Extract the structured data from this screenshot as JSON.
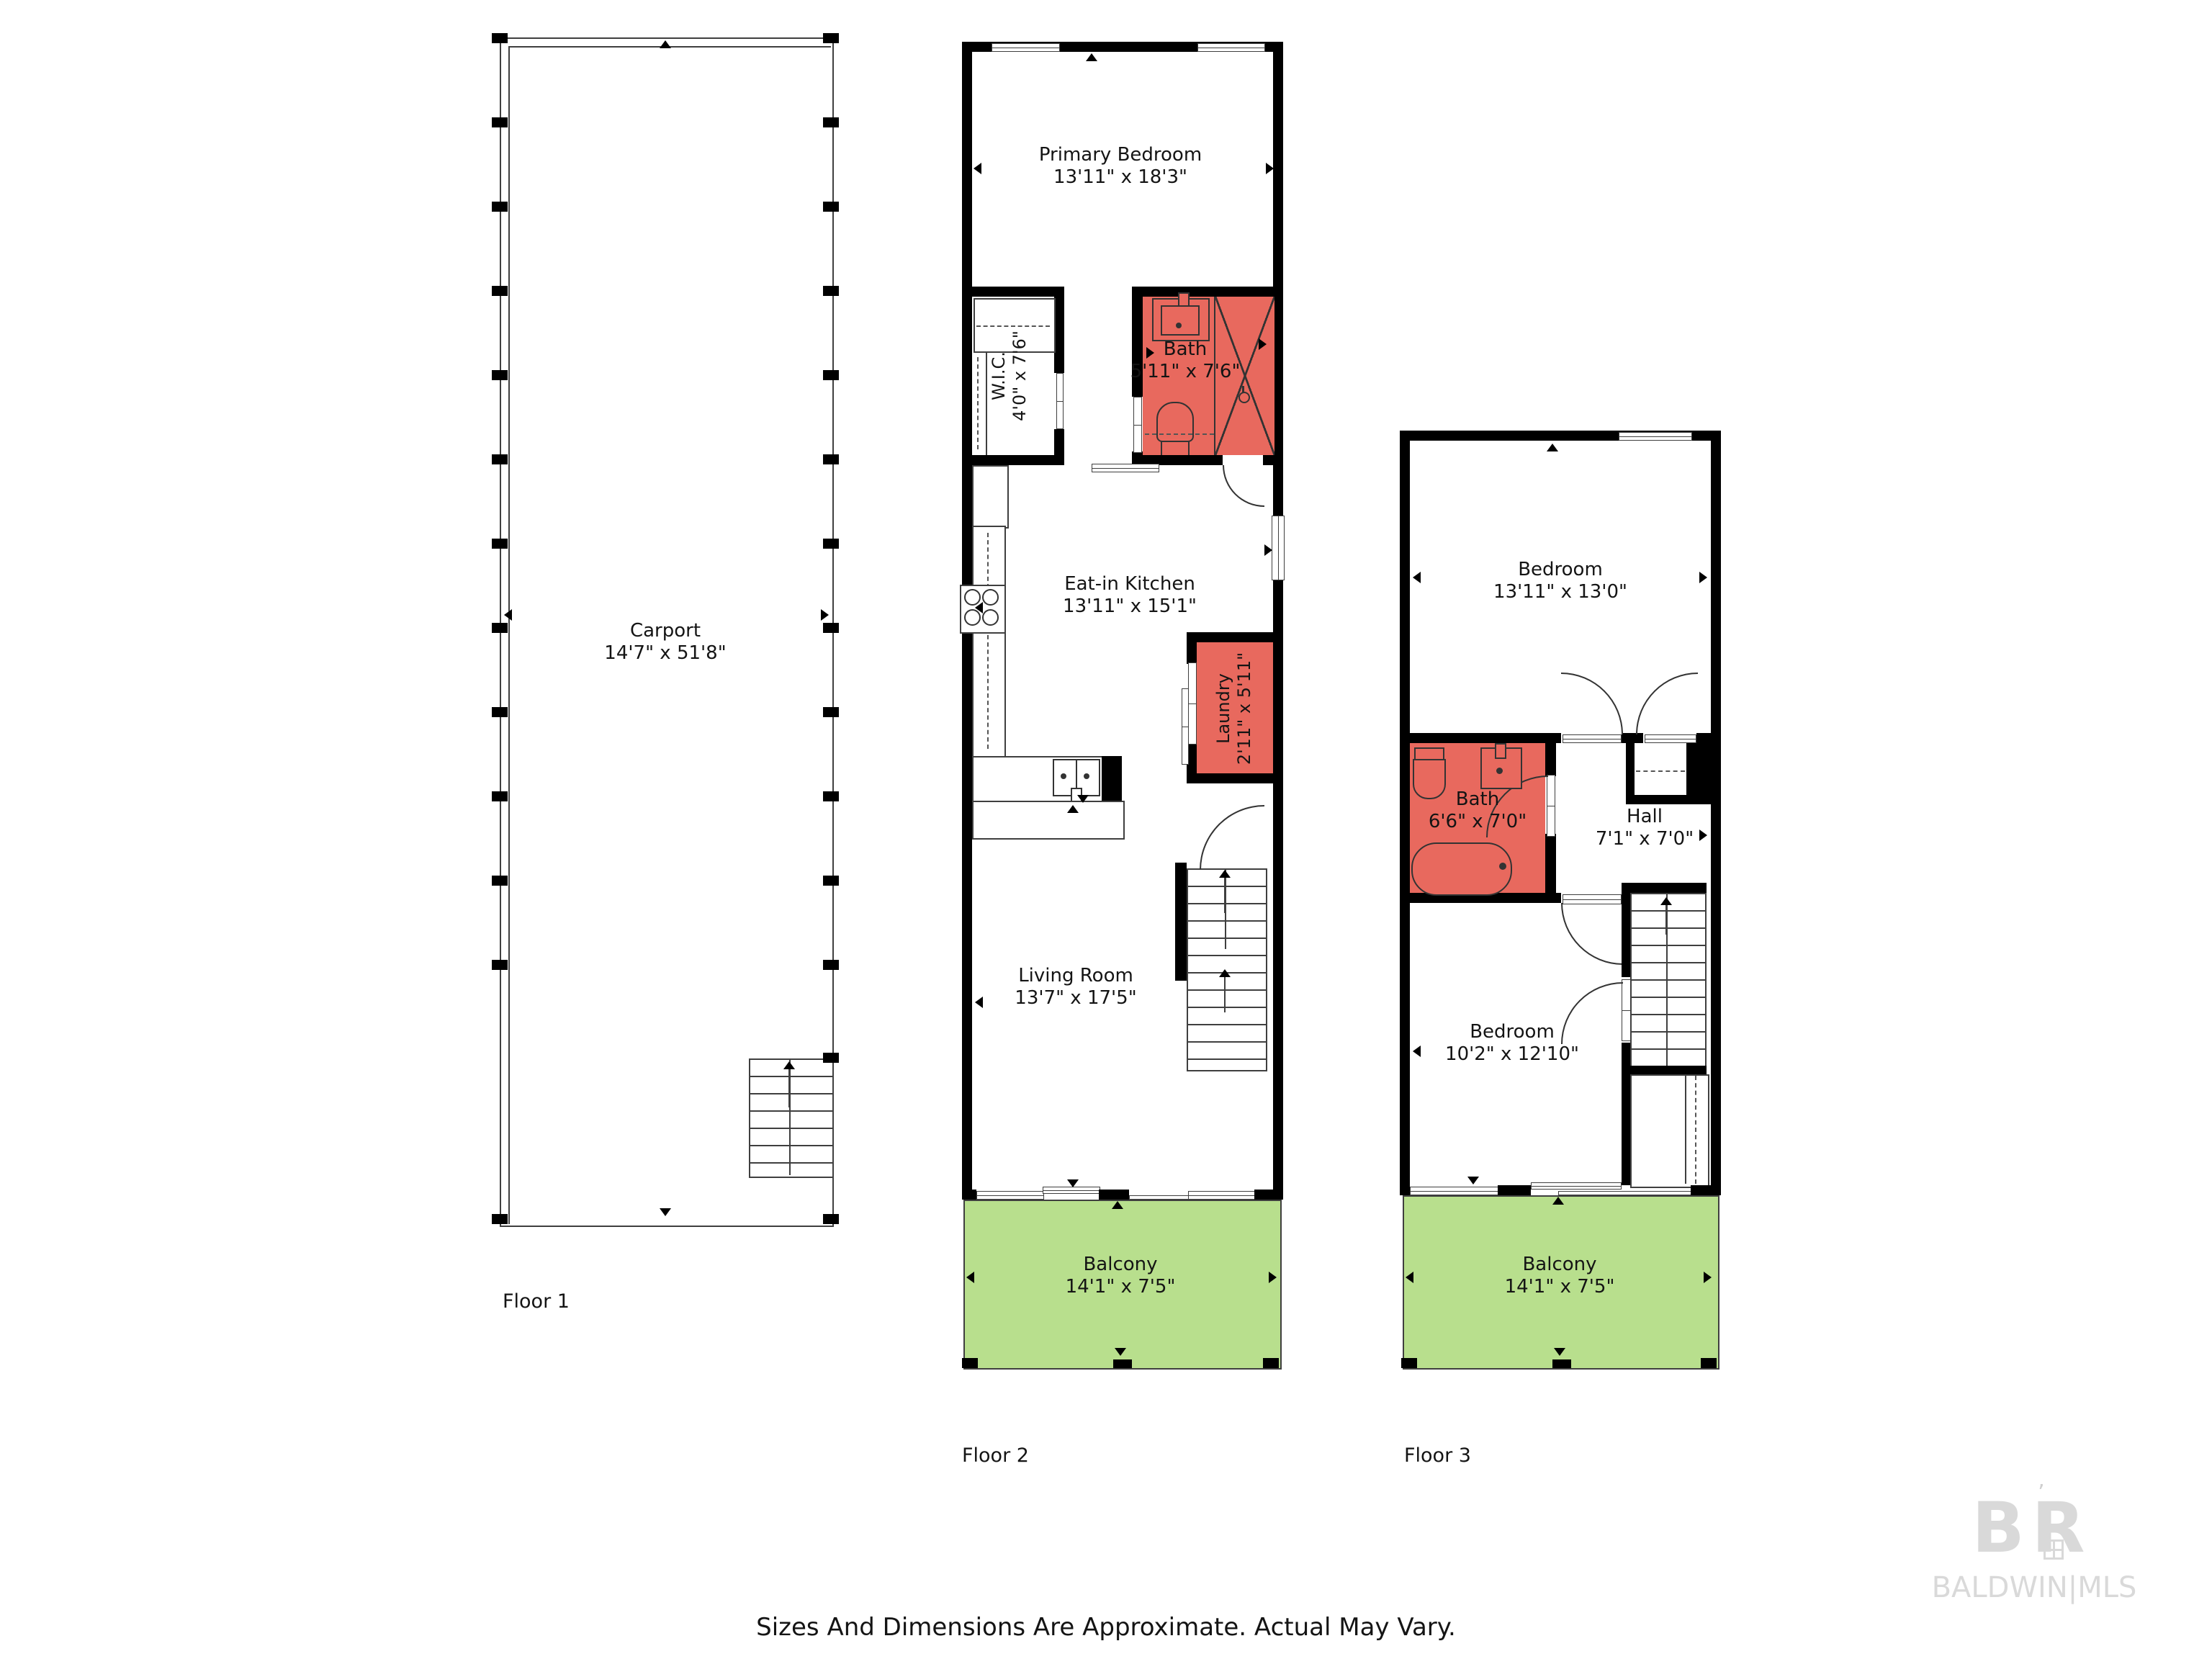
{
  "page": {
    "background": "#ffffff"
  },
  "palette": {
    "wall": "#000000",
    "line": "#3f3f3f",
    "bath_room_fill": "#E8695E",
    "balcony_fill": "#B8DF8D",
    "label_text": "#141414",
    "watermark_gray": "#D9D9D9"
  },
  "footer": {
    "disclaimer": "Sizes And Dimensions Are Approximate. Actual May Vary."
  },
  "watermark": {
    "mark": "BR",
    "name": "BALDWIN|MLS"
  },
  "floors": [
    {
      "label": "Floor 1",
      "rooms": [
        {
          "name": "Carport",
          "dims": "14'7\" x 51'8\""
        }
      ]
    },
    {
      "label": "Floor 2",
      "rooms": [
        {
          "name": "Primary Bedroom",
          "dims": "13'11\" x 18'3\""
        },
        {
          "name": "W.I.C.",
          "dims": "4'0\" x 7'6\""
        },
        {
          "name": "Bath",
          "dims": "5'11\" x 7'6\""
        },
        {
          "name": "Eat-in Kitchen",
          "dims": "13'11\" x 15'1\""
        },
        {
          "name": "Laundry",
          "dims": "2'11\" x 5'11\""
        },
        {
          "name": "Living Room",
          "dims": "13'7\" x 17'5\""
        },
        {
          "name": "Balcony",
          "dims": "14'1\" x 7'5\""
        }
      ]
    },
    {
      "label": "Floor 3",
      "rooms": [
        {
          "name": "Bedroom",
          "dims": "13'11\" x 13'0\""
        },
        {
          "name": "Bath",
          "dims": "6'6\" x 7'0\""
        },
        {
          "name": "Hall",
          "dims": "7'1\" x 7'0\""
        },
        {
          "name": "Bedroom",
          "dims": "10'2\" x 12'10\""
        },
        {
          "name": "Balcony",
          "dims": "14'1\" x 7'5\""
        }
      ]
    }
  ]
}
